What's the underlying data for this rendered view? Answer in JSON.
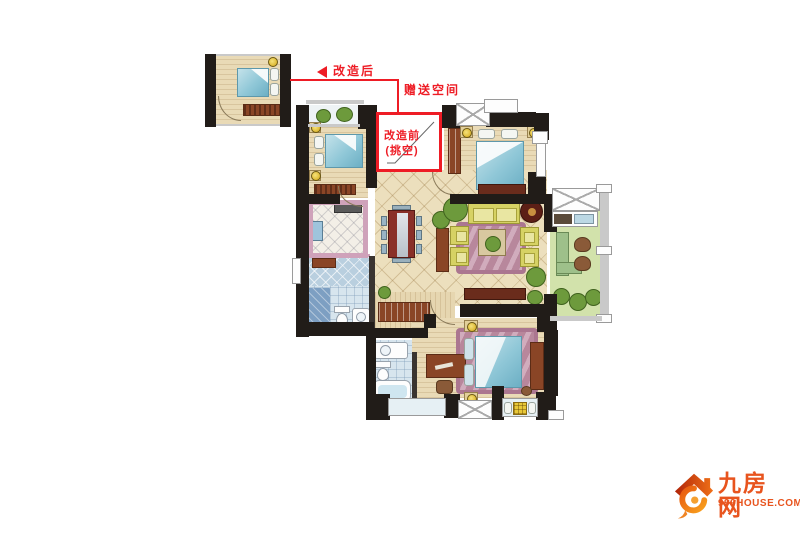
{
  "annotations": {
    "after_label": "改造后",
    "gift_label": "赠送空间",
    "before_line1": "改造前",
    "before_line2": "(挑空)",
    "accent_color": "#ee1c25"
  },
  "logo": {
    "site_name": "九房网",
    "site_url": "999HOUSE.COM",
    "brand_color": "#e8541e"
  }
}
